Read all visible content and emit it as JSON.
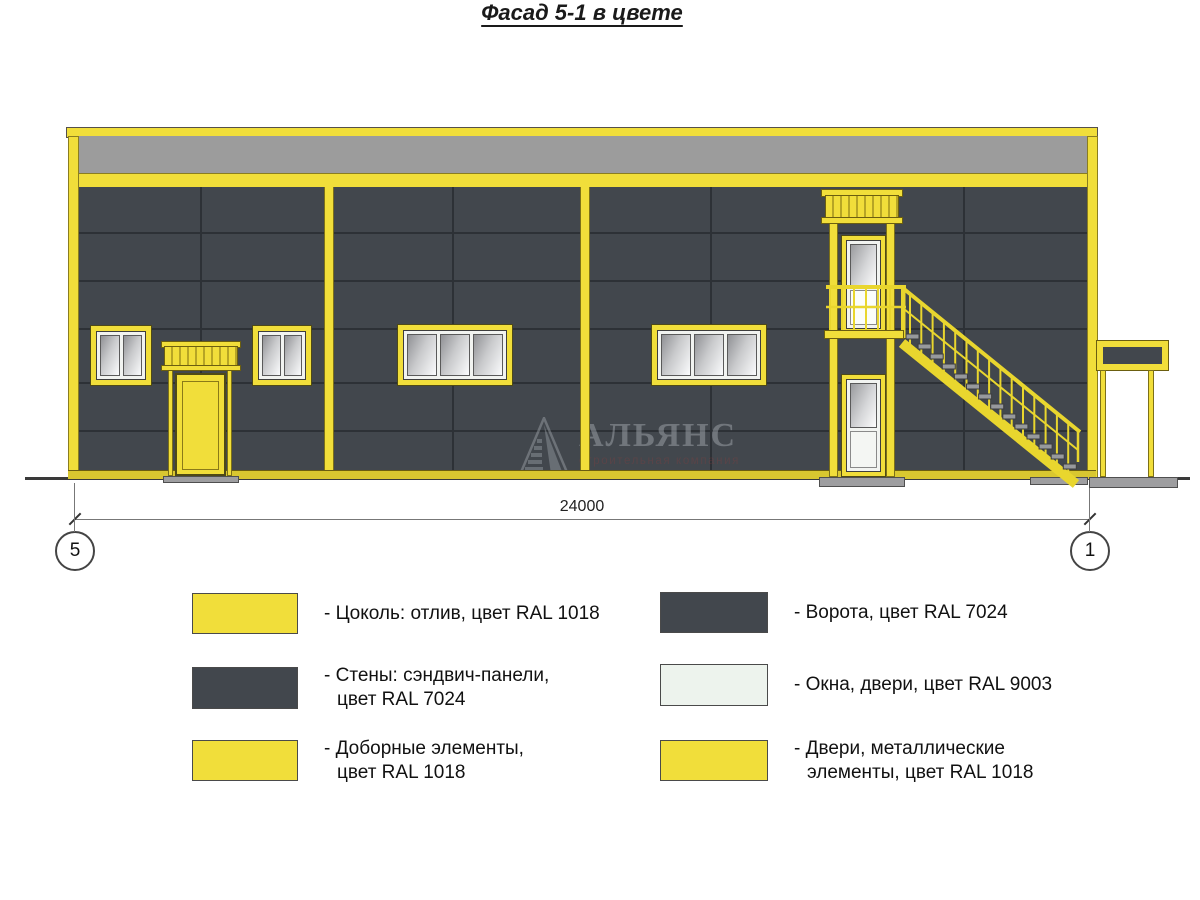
{
  "title": "Фасад 5-1 в цвете",
  "drawing": {
    "dimension_label": "24000",
    "axis_left": "5",
    "axis_right": "1"
  },
  "watermark": {
    "logo_icon": "alliance-triangle-logo",
    "name": "АЛЬЯНС",
    "subtitle": "строительная компания"
  },
  "colors": {
    "ral1018": "#f1de3a",
    "ral7024": "#42474d",
    "ral9003": "#edf3ed",
    "parapet": "#9c9c9c"
  },
  "legend": {
    "left": [
      {
        "color": "#f1de3a",
        "line1": "- Цоколь: отлив, цвет RAL 1018",
        "line2": ""
      },
      {
        "color": "#42474d",
        "line1": "- Стены: сэндвич-панели,",
        "line2": "цвет RAL 7024"
      },
      {
        "color": "#f1de3a",
        "line1": "- Доборные элементы,",
        "line2": "цвет RAL 1018"
      }
    ],
    "right": [
      {
        "color": "#42474d",
        "line1": "- Ворота, цвет RAL 7024",
        "line2": ""
      },
      {
        "color": "#edf3ed",
        "line1": "- Окна, двери, цвет RAL 9003",
        "line2": ""
      },
      {
        "color": "#f1de3a",
        "line1": "- Двери, металлические",
        "line2": "элементы, цвет RAL 1018"
      }
    ]
  }
}
